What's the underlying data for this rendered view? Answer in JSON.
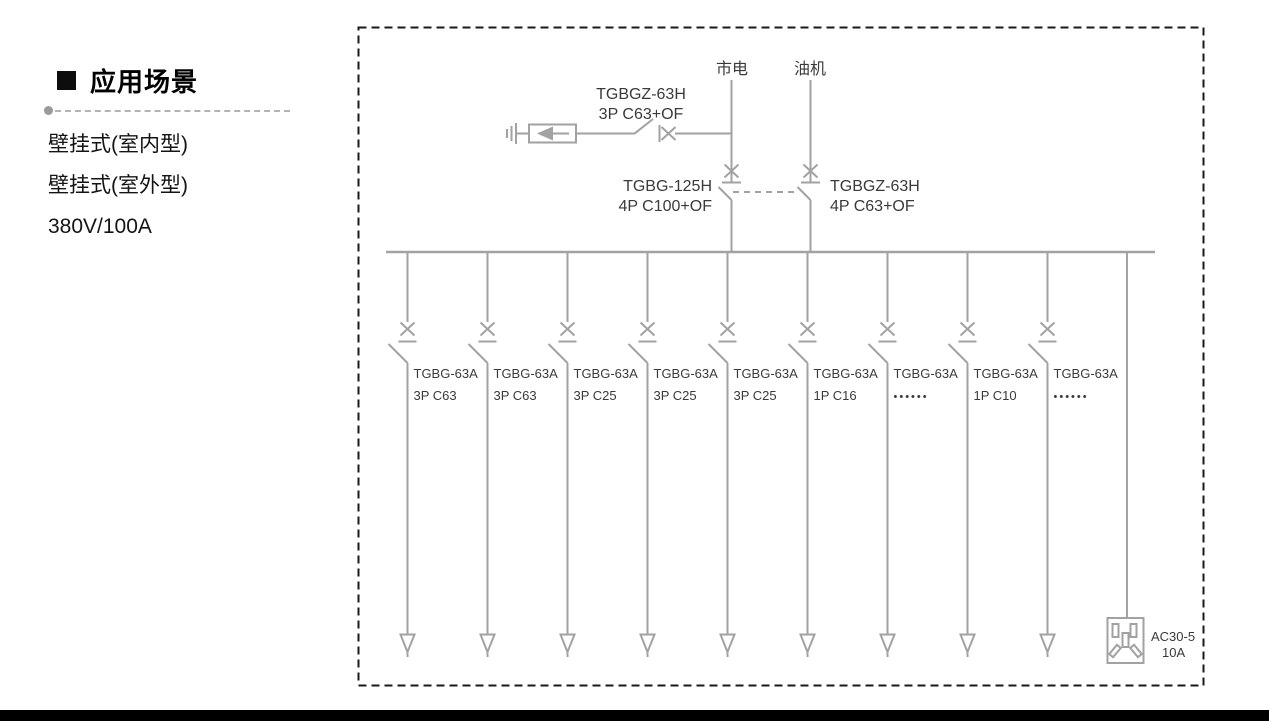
{
  "left_panel": {
    "heading": "应用场景",
    "items": [
      {
        "label": "壁挂式(室内型)"
      },
      {
        "label": "壁挂式(室外型)"
      },
      {
        "label": "380V/100A"
      }
    ]
  },
  "diagram": {
    "source_mains": "市电",
    "source_generator": "油机",
    "spd_breaker": {
      "model": "TGBGZ-63H",
      "spec": "3P C63+OF"
    },
    "transfer_left": {
      "model": "TGBG-125H",
      "spec": "4P C100+OF"
    },
    "transfer_right": {
      "model": "TGBGZ-63H",
      "spec": "4P C63+OF"
    },
    "branches": [
      {
        "model": "TGBG-63A",
        "spec": "3P C63"
      },
      {
        "model": "TGBG-63A",
        "spec": "3P C63"
      },
      {
        "model": "TGBG-63A",
        "spec": "3P C25"
      },
      {
        "model": "TGBG-63A",
        "spec": "3P C25"
      },
      {
        "model": "TGBG-63A",
        "spec": "3P C25"
      },
      {
        "model": "TGBG-63A",
        "spec": "1P C16"
      },
      {
        "model": "TGBG-63A",
        "spec": "••••••"
      },
      {
        "model": "TGBG-63A",
        "spec": "1P C10"
      },
      {
        "model": "TGBG-63A",
        "spec": "••••••"
      }
    ],
    "socket": {
      "model": "AC30-5",
      "rating": "10A"
    }
  },
  "colors": {
    "line": "#a2a2a2",
    "text": "#3a3a3a",
    "border": "#1a1a1a",
    "bar": "#000000"
  }
}
